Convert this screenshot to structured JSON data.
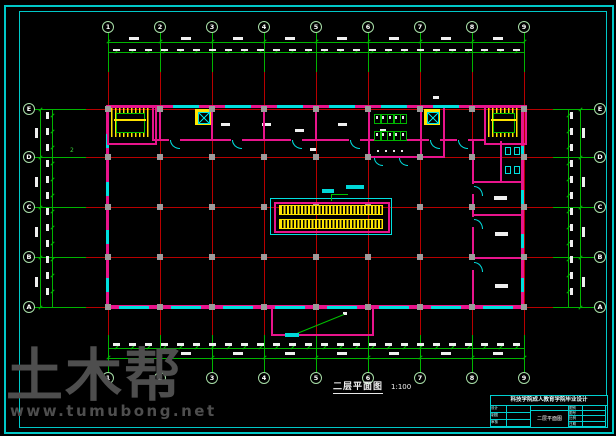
{
  "drawing": {
    "type": "CAD architectural floor plan",
    "sheet_background": "#000000"
  },
  "drawing_label": {
    "title": "二层平面图",
    "scale": "1:100"
  },
  "watermark": {
    "logo": "土木帮",
    "url": "www.tumubong.net"
  },
  "grid": {
    "columns": [
      "1",
      "2",
      "3",
      "4",
      "5",
      "6",
      "7",
      "8",
      "9"
    ],
    "rows_top_to_bottom": [
      "E",
      "D",
      "C",
      "B",
      "A"
    ]
  },
  "annotations": {
    "section_mark": "2"
  },
  "title_block": {
    "project": "科技学院成人教育学院毕业设计",
    "drawing_name": "二层平面图",
    "fields_left": [
      "设计",
      "制图",
      "审核"
    ],
    "fields_right": [
      "图别",
      "图号",
      "比例",
      "日期"
    ]
  },
  "colors": {
    "grid_red": "#b80000",
    "dimension_green": "#00b400",
    "wall_magenta": "#e8148c",
    "window_cyan": "#00e0e0",
    "stair_yellow": "#ffe400",
    "column_gray": "#9c9c9c",
    "border_cyan": "#00c8c8",
    "watermark_gray": "#4e4e4e"
  }
}
